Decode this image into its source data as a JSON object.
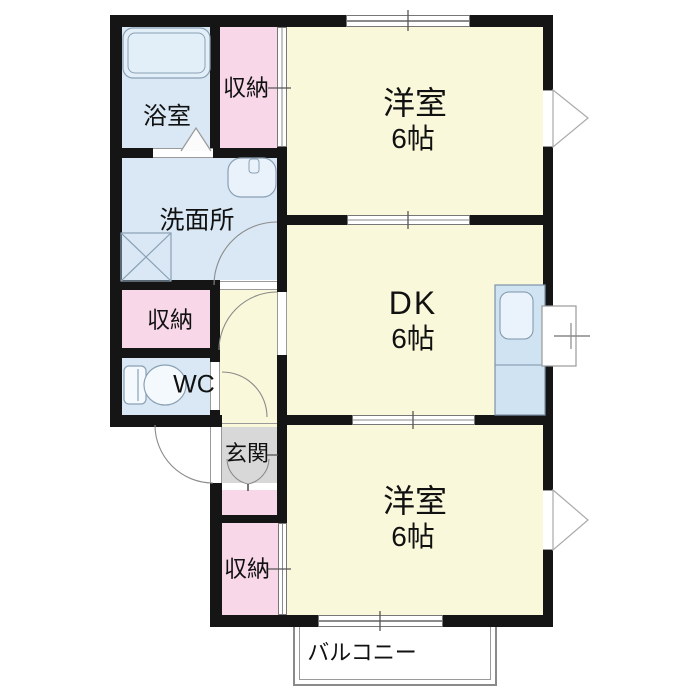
{
  "palette": {
    "room_yellow": "#FAF8DA",
    "storage_pink": "#F8D8E8",
    "water_blue": "#D9E8F4",
    "genkan_gray": "#D8D8D8",
    "wall_black": "#151515",
    "line_gray": "#8A8A8A"
  },
  "floorplan": {
    "rooms": {
      "western_room_top": {
        "name": "洋室",
        "size": "6帖"
      },
      "dining_kitchen": {
        "name": "DK",
        "size": "6帖"
      },
      "western_room_bottom": {
        "name": "洋室",
        "size": "6帖"
      },
      "bathroom": {
        "name": "浴室"
      },
      "washroom": {
        "name": "洗面所"
      },
      "closet_top": {
        "name": "収納"
      },
      "closet_middle": {
        "name": "収納"
      },
      "closet_bottom": {
        "name": "収納"
      },
      "toilet": {
        "name": "WC"
      },
      "entrance": {
        "name": "玄関"
      },
      "balcony": {
        "name": "バルコニー"
      }
    }
  }
}
